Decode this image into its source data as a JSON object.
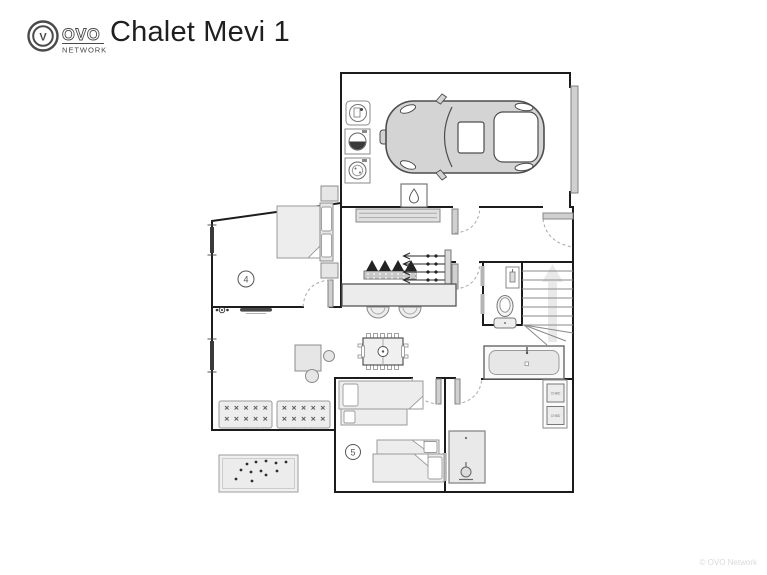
{
  "header": {
    "logo": {
      "monogram": "V",
      "brand": "OVO",
      "subtitle": "NETWORK"
    },
    "title": "Chalet Mevi 1"
  },
  "plan": {
    "floor_name": "Chalet Mevi 1",
    "rooms": [
      {
        "number": "4",
        "type": "double-bedroom"
      },
      {
        "number": "5",
        "type": "twin-bedroom"
      }
    ],
    "heater_labels": [
      "CHBD",
      "CHBD"
    ],
    "icons": [
      "washing-machine-icon",
      "tumble-dryer-icon",
      "appliance-icon",
      "water-heater-drop-icon",
      "car-icon",
      "toilet-icon",
      "bathtub-icon",
      "shower-icon",
      "stairs-icon",
      "foosball-table-icon",
      "boot-dryer-icon",
      "ski-rack-icon",
      "radiator-icon",
      "doormat-icon"
    ],
    "colors": {
      "wall": "#1c1c1c",
      "furniture_fill": "#e6e6e6",
      "car_fill": "#d4d4d4",
      "window_bar": "#3a3a3a"
    }
  },
  "footer": {
    "copyright": "© OVO Network"
  }
}
